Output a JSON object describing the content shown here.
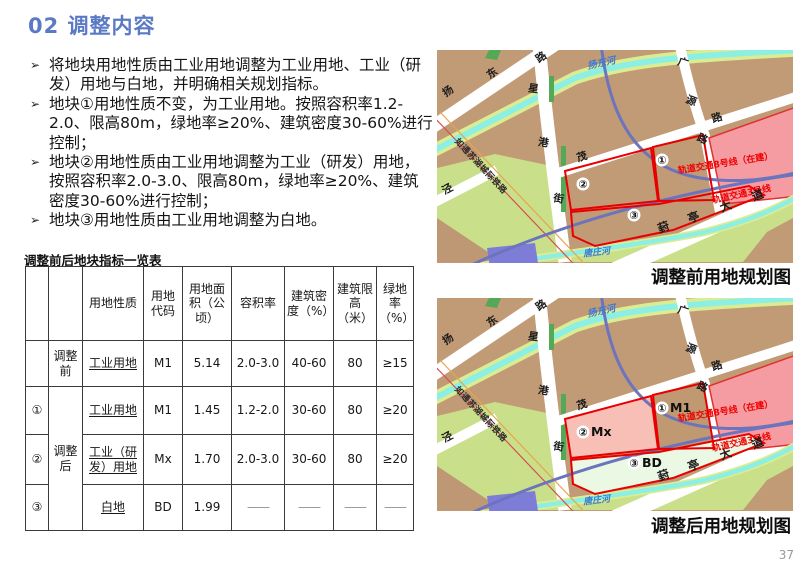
{
  "title": "02 调整内容",
  "bullets": [
    {
      "marker": "➢",
      "text": "将地块用地性质由工业用地调整为工业用地、工业（研发）用地与白地，并明确相关规划指标。"
    },
    {
      "marker": "➢",
      "text": "地块①用地性质不变，为工业用地。按照容积率1.2-2.0、限高80m，绿地率≥20%、建筑密度30-60%进行控制；"
    },
    {
      "marker": "➢",
      "text": "地块②用地性质由工业用地调整为工业（研发）用地，按照容积率2.0-3.0、限高80m，绿地率≥20%、建筑密度30-60%进行控制；"
    },
    {
      "marker": "➢",
      "text": "地块③用地性质由工业用地调整为白地。"
    }
  ],
  "table": {
    "title": "调整前后地块指标一览表",
    "headers": [
      "",
      "",
      "用地性质",
      "用地代码",
      "用地面积（公顷）",
      "容积率",
      "建筑密度（%）",
      "建筑限高（米）",
      "绿地率（%）"
    ],
    "rows": [
      {
        "plot": "",
        "phase": "调整前",
        "cells": [
          "工业用地",
          "M1",
          "5.14",
          "2.0-3.0",
          "40-60",
          "80",
          "≥15"
        ]
      },
      {
        "plot": "①",
        "phase": "调整后",
        "cells": [
          "工业用地",
          "M1",
          "1.45",
          "1.2-2.0",
          "30-60",
          "80",
          "≥20"
        ]
      },
      {
        "plot": "②",
        "cells": [
          "工业（研发）用地",
          "Mx",
          "1.70",
          "2.0-3.0",
          "30-60",
          "80",
          "≥20"
        ]
      },
      {
        "plot": "③",
        "cells": [
          "白地",
          "BD",
          "1.99",
          "——",
          "——",
          "——",
          "——"
        ]
      }
    ]
  },
  "maps": {
    "before": {
      "caption": "调整前用地规划图"
    },
    "after": {
      "caption": "调整后用地规划图",
      "plot_codes": {
        "p1": "M1",
        "p2": "Mx",
        "p3": "BD"
      }
    },
    "labels": {
      "yangdong_road": [
        "扬",
        "东",
        "路"
      ],
      "yangdong_river": "扬东河",
      "xinggang_street": [
        "星",
        "港",
        "街"
      ],
      "mao_road": [
        "茂",
        "路"
      ],
      "guangyuan_road": [
        "广",
        "源",
        "路"
      ],
      "jing_road": "泾",
      "railway": "如通苏湖城际铁路",
      "metro8": "轨道交通8号线（在建）",
      "metro3": "轨道交通3号线",
      "fengting_avenue": [
        "葑",
        "亭",
        "大",
        "道"
      ],
      "tangzhuang_river": "唐庄河",
      "plot_nums": [
        "①",
        "②",
        "③"
      ]
    }
  },
  "page_number": "37",
  "colors": {
    "title_blue": "#5B7AC5",
    "plot_outline_red": "#E80000",
    "metro_line_blue": "#6B74BC",
    "metro_label_red": "#F00000",
    "river_cyan": "#8BEFE3",
    "river_bank_green": "#DCEC92",
    "parcel_brown": "#C19A76",
    "green_area": "#C9DF8A",
    "strip_green": "#55A855",
    "pink_area": "#F59CA2",
    "plot2_fill_salmon": "#F7BFB6",
    "plot3_fill_mint": "#EAF8E4",
    "purple_parcel": "#7D7DD8",
    "page_number_gray": "#999999"
  }
}
